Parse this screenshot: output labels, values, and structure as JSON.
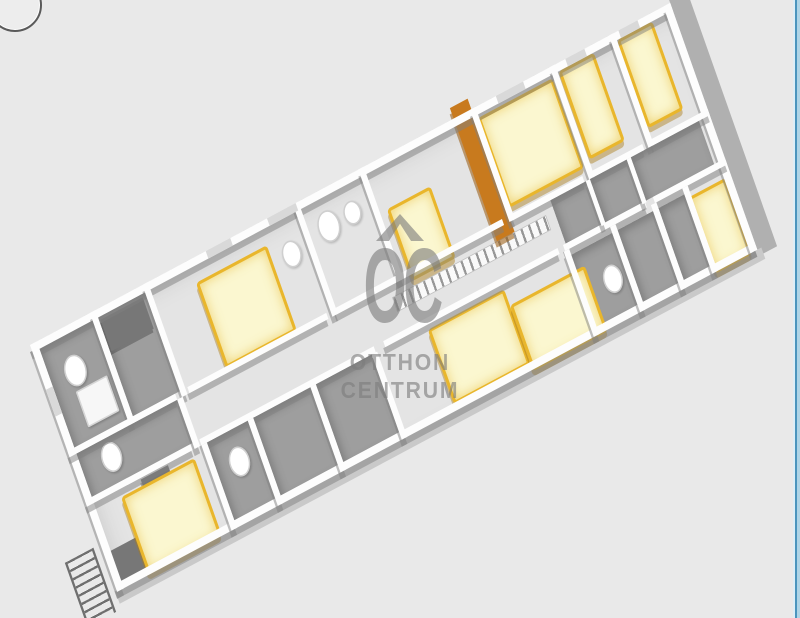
{
  "watermark": {
    "logo_text": "OC",
    "brand_line1": "OTTHON",
    "brand_line2": "CENTRUM"
  },
  "colors": {
    "background": "#e9e9e9",
    "building_floor": "#e4e4e4",
    "dark_floor": "#9e9e9e",
    "wall": "#fdfdfd",
    "wall_face_gray": "#808080",
    "bed_mattress": "#fbf7d0",
    "bed_frame": "#e9b62c",
    "wardrobe_orange": "#c87a1e",
    "watermark_gray": "#7d7d7d",
    "right_border_blue": "#4a94bd"
  },
  "floorplan": {
    "layers": [
      {
        "kind": "shell",
        "items": [
          {
            "n": "building-floor",
            "x": 0,
            "y": 0,
            "w": 940,
            "h": 330
          },
          {
            "n": "right-end-wall-face",
            "x": 940,
            "y": -6,
            "w": 26,
            "h": 344,
            "c": "#b0b0b0"
          },
          {
            "n": "front-wall-face",
            "x": -2,
            "y": 330,
            "w": 948,
            "h": 15,
            "c": "#c9c9c9"
          }
        ]
      },
      {
        "kind": "floor-dark",
        "items": [
          {
            "n": "bathroom-floor",
            "x": 10,
            "y": 10,
            "w": 78,
            "h": 132
          },
          {
            "n": "storage-floor",
            "x": 96,
            "y": 10,
            "w": 69,
            "h": 132
          },
          {
            "n": "bathroom-floor",
            "x": 10,
            "y": 150,
            "w": 148,
            "h": 58
          },
          {
            "n": "bathroom-floor",
            "x": 176,
            "y": 216,
            "w": 60,
            "h": 104
          },
          {
            "n": "dark-room-floor",
            "x": 244,
            "y": 216,
            "w": 84,
            "h": 104
          },
          {
            "n": "dark-room-floor",
            "x": 336,
            "y": 216,
            "w": 82,
            "h": 104
          },
          {
            "n": "closet-floor",
            "x": 706,
            "y": 150,
            "w": 52,
            "h": 58
          },
          {
            "n": "closet-floor",
            "x": 764,
            "y": 150,
            "w": 54,
            "h": 58
          },
          {
            "n": "closet-floor",
            "x": 824,
            "y": 150,
            "w": 100,
            "h": 58
          },
          {
            "n": "dark-room-floor",
            "x": 706,
            "y": 224,
            "w": 62,
            "h": 96
          },
          {
            "n": "dark-room-floor",
            "x": 776,
            "y": 224,
            "w": 52,
            "h": 96
          },
          {
            "n": "dark-room-floor",
            "x": 836,
            "y": 224,
            "w": 38,
            "h": 96
          }
        ]
      },
      {
        "kind": "hatch",
        "items": [
          {
            "n": "corridor-stair-hatch",
            "x": 468,
            "y": 164,
            "w": 224,
            "h": 18
          }
        ]
      },
      {
        "kind": "furn-dark",
        "items": [
          {
            "n": "wardrobe",
            "x": 8,
            "y": 280,
            "w": 42,
            "h": 46
          },
          {
            "n": "dresser",
            "x": 78,
            "y": 218,
            "w": 40,
            "h": 28
          },
          {
            "n": "wardrobe",
            "x": 98,
            "y": 14,
            "w": 62,
            "h": 42
          }
        ]
      },
      {
        "kind": "fixture",
        "items": [
          {
            "n": "toilet",
            "x": 30,
            "y": 36,
            "w": 26,
            "h": 36,
            "s": "oval"
          },
          {
            "n": "shower-tray",
            "x": 36,
            "y": 80,
            "w": 42,
            "h": 44,
            "s": "square"
          },
          {
            "n": "toilet",
            "x": 38,
            "y": 156,
            "w": 24,
            "h": 34,
            "s": "oval"
          },
          {
            "n": "sink",
            "x": 350,
            "y": 38,
            "w": 22,
            "h": 30,
            "s": "oval"
          },
          {
            "n": "toilet",
            "x": 406,
            "y": 26,
            "w": 26,
            "h": 36,
            "s": "oval"
          },
          {
            "n": "sink",
            "x": 444,
            "y": 30,
            "w": 20,
            "h": 26,
            "s": "oval"
          },
          {
            "n": "toilet",
            "x": 194,
            "y": 238,
            "w": 24,
            "h": 34,
            "s": "oval"
          },
          {
            "n": "toilet",
            "x": 736,
            "y": 258,
            "w": 22,
            "h": 32,
            "s": "oval"
          }
        ]
      },
      {
        "kind": "bed",
        "items": [
          {
            "n": "double-bed",
            "x": 232,
            "y": 30,
            "w": 96,
            "h": 106
          },
          {
            "n": "double-bed",
            "x": 46,
            "y": 226,
            "w": 100,
            "h": 96
          },
          {
            "n": "double-bed",
            "x": 498,
            "y": 222,
            "w": 104,
            "h": 92
          },
          {
            "n": "double-bed",
            "x": 610,
            "y": 244,
            "w": 102,
            "h": 80
          },
          {
            "n": "single-bed",
            "x": 500,
            "y": 62,
            "w": 56,
            "h": 88
          },
          {
            "n": "double-bed",
            "x": 652,
            "y": 14,
            "w": 102,
            "h": 112
          },
          {
            "n": "single-bed",
            "x": 772,
            "y": 10,
            "w": 44,
            "h": 110
          },
          {
            "n": "single-bed",
            "x": 858,
            "y": 10,
            "w": 44,
            "h": 110
          },
          {
            "n": "single-bed",
            "x": 878,
            "y": 230,
            "w": 46,
            "h": 94
          }
        ]
      },
      {
        "kind": "wardrobe-orange",
        "items": [
          {
            "n": "tall-wardrobe",
            "x": 622,
            "y": -14,
            "w": 26,
            "h": 178
          }
        ]
      },
      {
        "kind": "wall",
        "items": [
          {
            "n": "exterior-wall-back",
            "x": 0,
            "y": 0,
            "w": 940,
            "h": 10
          },
          {
            "n": "exterior-wall-front",
            "x": 0,
            "y": 320,
            "w": 940,
            "h": 10
          },
          {
            "n": "exterior-wall-left",
            "x": 0,
            "y": 0,
            "w": 10,
            "h": 330
          },
          {
            "n": "exterior-wall-right",
            "x": 930,
            "y": 0,
            "w": 10,
            "h": 330
          },
          {
            "n": "interior-wall",
            "x": 88,
            "y": 0,
            "w": 8,
            "h": 150
          },
          {
            "n": "interior-wall",
            "x": 165,
            "y": 0,
            "w": 8,
            "h": 150
          },
          {
            "n": "interior-wall",
            "x": 386,
            "y": 0,
            "w": 8,
            "h": 150
          },
          {
            "n": "interior-wall",
            "x": 482,
            "y": 0,
            "w": 8,
            "h": 150
          },
          {
            "n": "interior-wall",
            "x": 646,
            "y": 0,
            "w": 8,
            "h": 150
          },
          {
            "n": "interior-wall",
            "x": 763,
            "y": 0,
            "w": 8,
            "h": 150
          },
          {
            "n": "interior-wall",
            "x": 850,
            "y": 0,
            "w": 8,
            "h": 150
          },
          {
            "n": "corridor-wall",
            "x": 0,
            "y": 142,
            "w": 158,
            "h": 8
          },
          {
            "n": "corridor-wall",
            "x": 176,
            "y": 142,
            "w": 204,
            "h": 8
          },
          {
            "n": "corridor-wall",
            "x": 392,
            "y": 142,
            "w": 246,
            "h": 8
          },
          {
            "n": "corridor-wall",
            "x": 650,
            "y": 142,
            "w": 106,
            "h": 8
          },
          {
            "n": "corridor-wall",
            "x": 768,
            "y": 142,
            "w": 76,
            "h": 8
          },
          {
            "n": "corridor-wall",
            "x": 856,
            "y": 142,
            "w": 84,
            "h": 8
          },
          {
            "n": "corridor-wall",
            "x": 0,
            "y": 208,
            "w": 156,
            "h": 8
          },
          {
            "n": "corridor-wall",
            "x": 168,
            "y": 208,
            "w": 256,
            "h": 8
          },
          {
            "n": "corridor-wall",
            "x": 438,
            "y": 208,
            "w": 256,
            "h": 8
          },
          {
            "n": "corridor-wall",
            "x": 702,
            "y": 208,
            "w": 120,
            "h": 8
          },
          {
            "n": "corridor-wall",
            "x": 834,
            "y": 208,
            "w": 106,
            "h": 8
          },
          {
            "n": "interior-wall",
            "x": 168,
            "y": 216,
            "w": 8,
            "h": 114
          },
          {
            "n": "interior-wall",
            "x": 236,
            "y": 216,
            "w": 8,
            "h": 114
          },
          {
            "n": "interior-wall",
            "x": 328,
            "y": 216,
            "w": 8,
            "h": 114
          },
          {
            "n": "interior-wall",
            "x": 418,
            "y": 216,
            "w": 8,
            "h": 114
          },
          {
            "n": "interior-wall",
            "x": 700,
            "y": 216,
            "w": 8,
            "h": 114
          },
          {
            "n": "interior-wall",
            "x": 768,
            "y": 216,
            "w": 8,
            "h": 114
          },
          {
            "n": "interior-wall",
            "x": 828,
            "y": 216,
            "w": 8,
            "h": 114
          },
          {
            "n": "interior-wall",
            "x": 874,
            "y": 216,
            "w": 8,
            "h": 114
          },
          {
            "n": "interior-wall",
            "x": 158,
            "y": 150,
            "w": 8,
            "h": 66
          },
          {
            "n": "interior-wall",
            "x": 758,
            "y": 150,
            "w": 6,
            "h": 60
          },
          {
            "n": "interior-wall",
            "x": 818,
            "y": 150,
            "w": 6,
            "h": 60
          }
        ]
      },
      {
        "kind": "window",
        "items": [
          {
            "n": "window",
            "x": 258,
            "y": 0,
            "w": 36,
            "h": 10
          },
          {
            "n": "window",
            "x": 348,
            "y": 0,
            "w": 42,
            "h": 10
          },
          {
            "n": "window",
            "x": 684,
            "y": 0,
            "w": 40,
            "h": 10
          },
          {
            "n": "window",
            "x": 786,
            "y": 0,
            "w": 28,
            "h": 10
          },
          {
            "n": "window",
            "x": 864,
            "y": 0,
            "w": 28,
            "h": 10
          },
          {
            "n": "window",
            "x": 0,
            "y": 60,
            "w": 10,
            "h": 36
          }
        ]
      },
      {
        "kind": "ladder",
        "items": [
          {
            "n": "escape-ladder",
            "x": -52,
            "y": 266,
            "w": 36,
            "h": 86
          }
        ]
      }
    ]
  }
}
